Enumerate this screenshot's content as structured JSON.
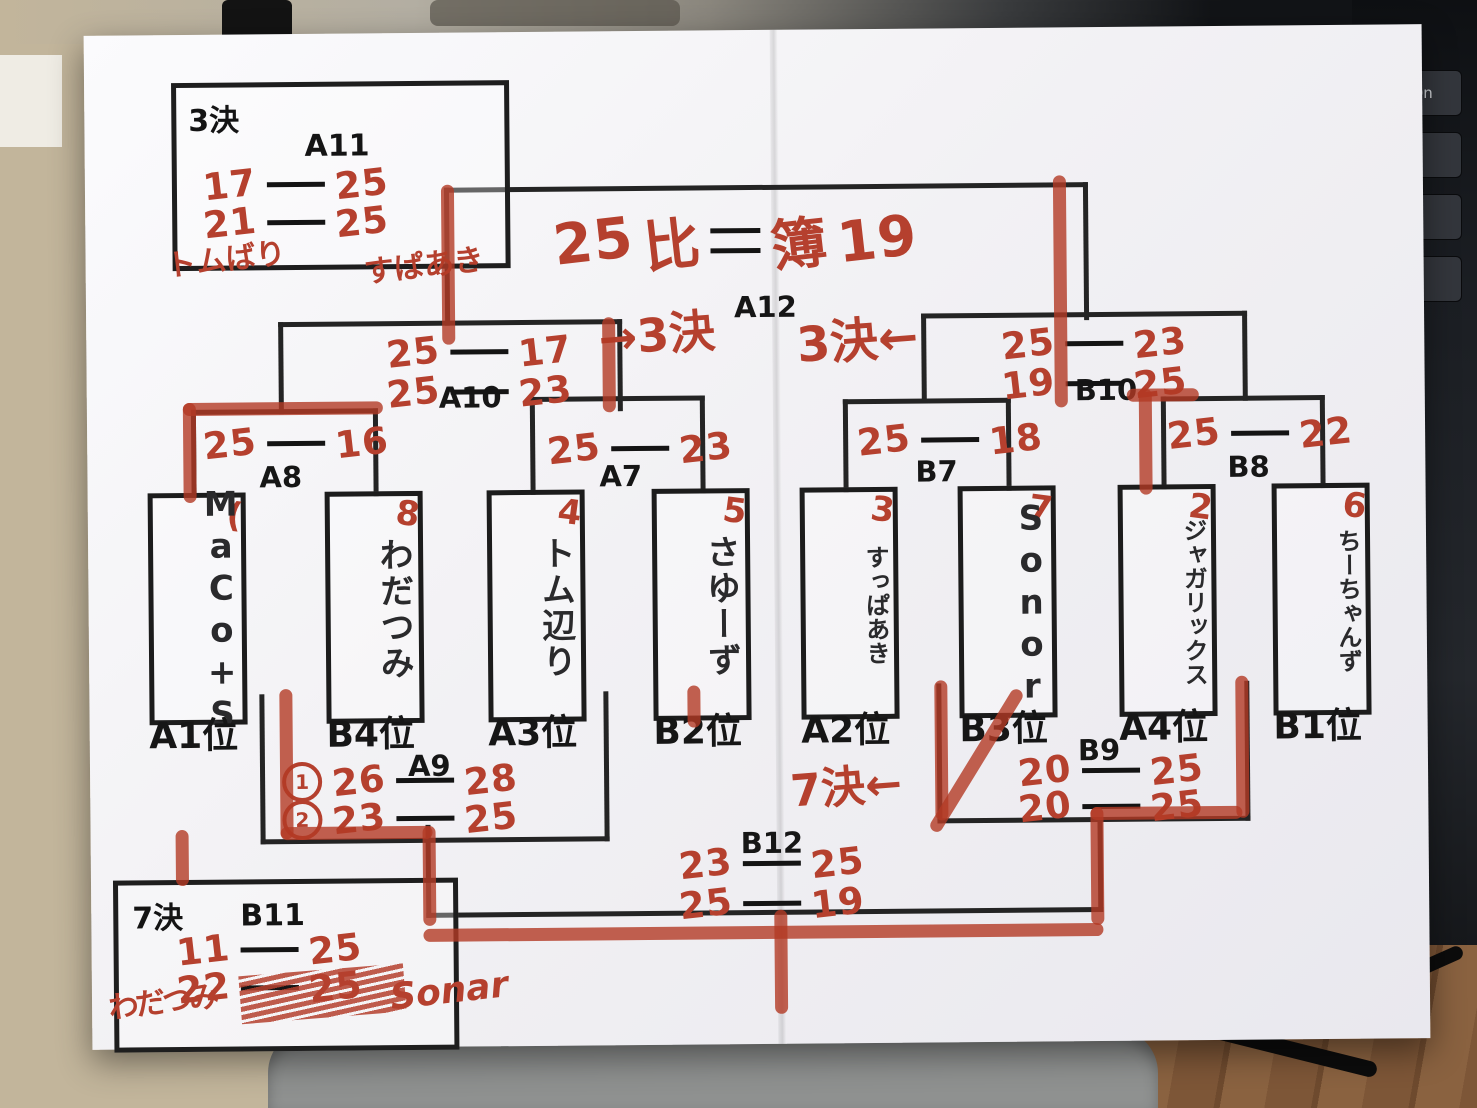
{
  "colors": {
    "marker_red": "#b5402e",
    "ink_black": "#1c1c1c"
  },
  "background": {
    "keyboard_keys": [
      "PgDn",
      "¥",
      "む"
    ]
  },
  "final": {
    "label": "A12",
    "left_score": "25",
    "left_char": "比",
    "right_char": "簿",
    "right_score": "19"
  },
  "notes": {
    "third_left": "→3決",
    "third_right": "3決←",
    "seventh": "7決←"
  },
  "semis": {
    "a10": {
      "label": "A10",
      "s1l": "25",
      "s1r": "17",
      "s2l": "25",
      "s2r": "23"
    },
    "b10": {
      "label": "B10",
      "s1l": "25",
      "s1r": "23",
      "s2l": "19",
      "s2r": "25"
    }
  },
  "quarters": {
    "a8": {
      "label": "A8",
      "l": "25",
      "r": "16"
    },
    "a7": {
      "label": "A7",
      "l": "25",
      "r": "23"
    },
    "b7": {
      "label": "B7",
      "l": "25",
      "r": "18"
    },
    "b8": {
      "label": "B8",
      "l": "25",
      "r": "22"
    }
  },
  "teams": [
    {
      "name": "MaCo+S",
      "seed": "(",
      "rank": "A1位"
    },
    {
      "name": "わだつみ",
      "seed": "8",
      "rank": "B4位"
    },
    {
      "name": "トム辺り",
      "seed": "4",
      "rank": "A3位"
    },
    {
      "name": "さゆーず",
      "seed": "5",
      "rank": "B2位"
    },
    {
      "name": "すっぱあき",
      "seed": "3",
      "rank": "A2位"
    },
    {
      "name": "Sonor",
      "seed": "7",
      "rank": "B3位"
    },
    {
      "name": "ジャガリックス",
      "seed": "2",
      "rank": "A4位"
    },
    {
      "name": "ちーちゃんず",
      "seed": "6",
      "rank": "B1位"
    }
  ],
  "consolation": {
    "a9": {
      "label": "A9",
      "m1": "1",
      "s1l": "26",
      "s1r": "28",
      "m2": "2",
      "s2l": "23",
      "s2r": "25"
    },
    "b9": {
      "label": "B9",
      "s1l": "20",
      "s1r": "25",
      "s2l": "20",
      "s2r": "25"
    },
    "b12": {
      "label": "B12",
      "s1l": "23",
      "s1r": "25",
      "s2l": "25",
      "s2r": "19"
    }
  },
  "third_box": {
    "title": "3決",
    "match": "A11",
    "s1l": "17",
    "s1r": "25",
    "s2l": "21",
    "s2r": "25",
    "name_left": "トムばり",
    "name_right": "すぱあき"
  },
  "seventh_box": {
    "title": "7決",
    "match": "B11",
    "s1l": "11",
    "s1r": "25",
    "s2l": "22",
    "s2r": "25",
    "name_left": "わだつみ",
    "name_right": "Sonar"
  }
}
